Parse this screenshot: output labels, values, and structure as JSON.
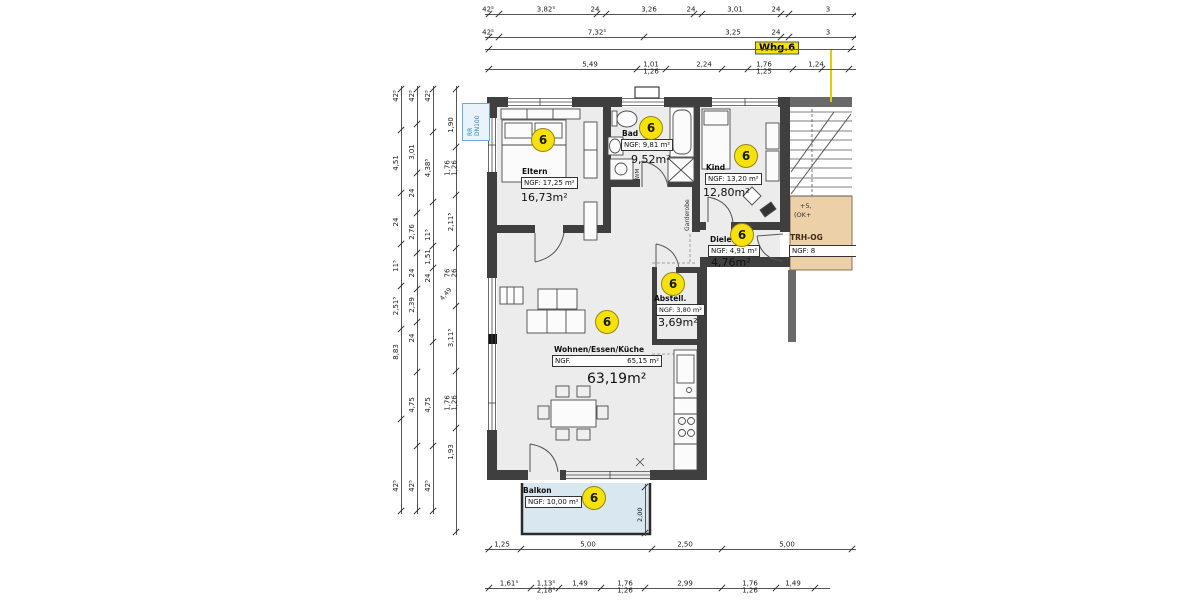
{
  "apartment_label": "Whg.6",
  "rooms": [
    {
      "id": "eltern",
      "name": "Eltern",
      "ngf": "NGF: 17,25 m²",
      "area": "16,73m²",
      "marker": "6"
    },
    {
      "id": "bad",
      "name": "Bad",
      "ngf": "NGF: 9,81 m²",
      "area": "9,52m²",
      "marker": "6"
    },
    {
      "id": "kind",
      "name": "Kind",
      "ngf": "NGF: 13,20 m²",
      "area": "12,80m²",
      "marker": "6"
    },
    {
      "id": "diele",
      "name": "Diele",
      "ngf": "NGF: 4,91 m²",
      "area": "4,76m²",
      "marker": "6"
    },
    {
      "id": "abstell",
      "name": "Abstell.",
      "ngf": "NGF: 3,80 m²",
      "area": "3,69m²",
      "marker": "6"
    },
    {
      "id": "wohnen",
      "name": "Wohnen/Essen/Küche",
      "ngf_label": "NGF.",
      "ngf_value": "65,15 m²",
      "area": "63,19m²",
      "marker": "6"
    },
    {
      "id": "balkon",
      "name": "Balkon",
      "ngf": "NGF: 10,00 m²",
      "marker": "6"
    }
  ],
  "stairwell": {
    "note_line1": "+5,",
    "note_line2": "(OK+",
    "name": "TRH-OG",
    "ngf": "NGF: 8"
  },
  "annotations": {
    "rr_line1": "RR",
    "rr_line2": "DN100",
    "garderobe": "Garderobe",
    "wm": "WM",
    "balcony_depth": "2,00",
    "diagonal_note": "4,49"
  },
  "dimensions": {
    "top_row1": [
      "42⁵",
      "3,82⁵",
      "24",
      "3,26",
      "24",
      "3,01",
      "24",
      "3"
    ],
    "top_row2": [
      "42⁵",
      "7,32⁵",
      "3,25",
      "24",
      "3"
    ],
    "top_row4": [
      "5,49",
      "1,01|1,26",
      "2,24",
      "1,76|1,25",
      "1,24"
    ],
    "left_chain1": [
      "42⁵",
      "4,51",
      "24",
      "11⁵",
      "2,51⁵",
      "8,83",
      "42⁵"
    ],
    "left_chain2": [
      "42⁵",
      "3,01",
      "24",
      "2,76",
      "24",
      "2,39",
      "24",
      "4,75",
      "42⁵"
    ],
    "left_chain3": [
      "42⁵",
      "4,38⁵",
      "11⁵",
      "1,51",
      "24",
      "4,75",
      "42⁵"
    ],
    "left_chain4": [
      "1,90",
      "1,76|1,26",
      "2,11⁵",
      "76|26",
      "3,11⁵",
      "1,76|1,26",
      "1,93"
    ],
    "bottom_row1": [
      "1,25",
      "5,00",
      "2,50",
      "5,00"
    ],
    "bottom_row2": [
      "1,61⁵",
      "1,13⁵|2,18⁵",
      "1,49",
      "1,76|1,26",
      "2,99",
      "1,76|1,26",
      "1,49"
    ]
  },
  "colors": {
    "marker_yellow": "#f6e20a",
    "highlight_yellow": "#f6e20a",
    "balcony_blue": "#d8e7f0",
    "stair_landing_tan": "#ecd0a8",
    "floor_gray": "#ececec",
    "wall_dark": "#3f3f3f",
    "rr_label_blue": "#2e75b6"
  }
}
